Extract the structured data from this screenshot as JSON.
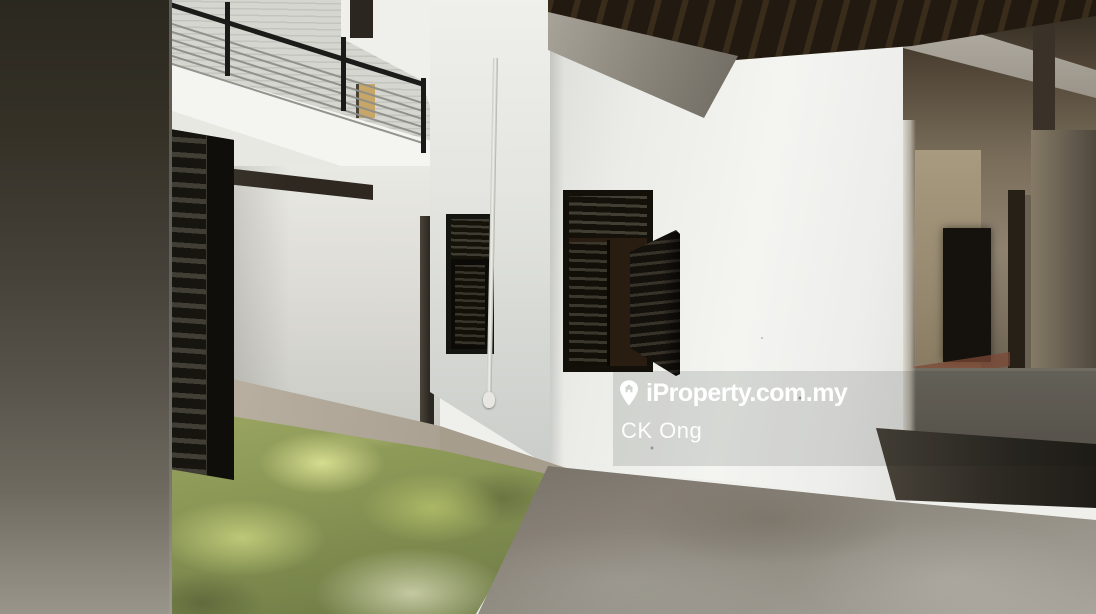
{
  "image": {
    "kind": "real-estate interior photograph",
    "width_px": 1096,
    "height_px": 614,
    "caption": "Empty double-storey property interior courtyard: white walls with black louvered shutters, mezzanine balcony with black cable railing, dark timber eaves, moss-covered courtyard floor, bare concrete corridor leading to dim hallway"
  },
  "watermark": {
    "brand": "iProperty.com.my",
    "agent_name": "CK Ong",
    "icon": "location-pin-house-icon",
    "text_color": "#ffffff"
  },
  "palette": {
    "wall_white": "#f2f3ef",
    "shutter_black": "#16140f",
    "timber_ceiling": "#231a10",
    "moss_green": "#8f9c57",
    "concrete_gray": "#8d887e",
    "foreground_wall": "#46423a"
  }
}
